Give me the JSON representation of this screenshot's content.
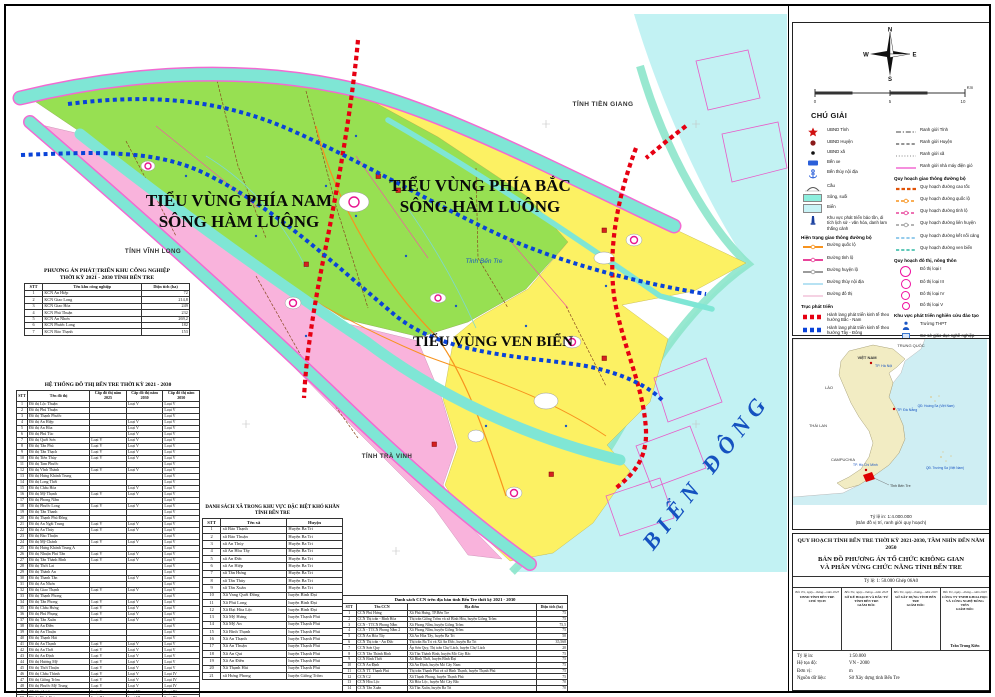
{
  "colors": {
    "region_north": "#97e052",
    "region_south": "#f9b3dc",
    "region_coast": "#fcf163",
    "sea": "#c2f2f3",
    "river": "#7fe6d5",
    "corridor_ns": "#e60012",
    "corridor_we": "#0a43d8",
    "province_boundary": "#f26ad2"
  },
  "map": {
    "labels": {
      "region_south_1": "TIỂU VÙNG PHÍA NAM",
      "region_south_2": "SÔNG HÀM LUÔNG",
      "region_north_1": "TIỂU VÙNG PHÍA BẮC",
      "region_north_2": "SÔNG HÀM LUÔNG",
      "region_coast": "TIỂU VÙNG VEN BIỂN",
      "tien_giang": "TỈNH TIỀN GIANG",
      "vinh_long": "TỈNH VĨNH LONG",
      "tra_vinh": "TỈNH TRÀ VINH",
      "ben_tre": "Tỉnh Bến Tre",
      "sea": "BIỂN ĐÔNG",
      "scale": "TỶ LỆ 1: 50 000"
    }
  },
  "tables": {
    "industrial": {
      "title1": "PHƯƠNG ÁN PHÁT TRIỂN KHU CÔNG NGHIỆP",
      "title2": "THỜI KỲ 2021 - 2030 TỈNH BẾN TRE",
      "headers": [
        "STT",
        "Tên khu công nghiệp",
        "Diện tích (ha)"
      ],
      "rows": [
        [
          "1",
          "KCN An Hiệp",
          "72"
        ],
        [
          "2",
          "KCN Giao Long",
          "214,8"
        ],
        [
          "3",
          "KCN Giao Hòa",
          "249"
        ],
        [
          "4",
          "KCN Phú Thuận",
          "232"
        ],
        [
          "5",
          "KCN An Nhơn",
          "269,2"
        ],
        [
          "6",
          "KCN Phước Long",
          "182"
        ],
        [
          "7",
          "KCN Bảo Thạnh",
          "153"
        ]
      ]
    },
    "urban": {
      "title1": "HỆ THỐNG ĐÔ THỊ BẾN TRE THỜI KỲ 2021 - 2030",
      "headers": [
        "STT",
        "Tên đô thị",
        "Cấp đô thị năm 2025",
        "Cấp đô thị năm 2030",
        "Cấp đô thị năm 2050"
      ],
      "rows": [
        [
          "1",
          "Đô thị Lộc Thuận",
          "",
          "Loại V",
          "Loại V"
        ],
        [
          "2",
          "Đô thị Phú Thuận",
          "",
          "",
          "Loại V"
        ],
        [
          "3",
          "Đô thị Thạnh Phước",
          "",
          "",
          "Loại V"
        ],
        [
          "4",
          "Đô thị An Hiệp",
          "",
          "Loại V",
          "Loại V"
        ],
        [
          "5",
          "Đô thị An Hòa",
          "",
          "Loại V",
          "Loại V"
        ],
        [
          "6",
          "Đô thị Phú Túc",
          "",
          "Loại V",
          "Loại V"
        ],
        [
          "7",
          "Đô thị Quới Sơn",
          "Loại V",
          "Loại V",
          "Loại V"
        ],
        [
          "8",
          "Đô thị Tân Phú",
          "Loại V",
          "Loại V",
          "Loại V"
        ],
        [
          "9",
          "Đô thị Tân Thạch",
          "Loại V",
          "Loại V",
          "Loại V"
        ],
        [
          "10",
          "Đô thị Tiên Thủy",
          "Loại V",
          "Loại V",
          "Loại V"
        ],
        [
          "11",
          "Đô thị Tam Phước",
          "",
          "",
          "Loại V"
        ],
        [
          "12",
          "Đô thị Vĩnh Thành",
          "Loại V",
          "Loại V",
          "Loại V"
        ],
        [
          "13",
          "Đô thị Hưng Khánh Trung",
          "",
          "",
          "Loại V"
        ],
        [
          "14",
          "Đô thị Long Thới",
          "",
          "",
          "Loại V"
        ],
        [
          "15",
          "Đô thị Châu Hòa",
          "",
          "Loại V",
          "Loại V"
        ],
        [
          "16",
          "Đô thị Mỹ Thạnh",
          "Loại V",
          "Loại V",
          "Loại V"
        ],
        [
          "17",
          "Đô thị Phong Nẫm",
          "",
          "",
          "Loại V"
        ],
        [
          "18",
          "Đô thị Phước Long",
          "Loại V",
          "Loại V",
          "Loại V"
        ],
        [
          "19",
          "Đô thị Tân Thanh",
          "",
          "",
          "Loại V"
        ],
        [
          "20",
          "Đô thị Thạnh Phú Đông",
          "",
          "",
          "Loại V"
        ],
        [
          "21",
          "Đô thị An Ngãi Trung",
          "Loại V",
          "Loại V",
          "Loại V"
        ],
        [
          "22",
          "Đô thị An Thủy",
          "Loại V",
          "Loại V",
          "Loại V"
        ],
        [
          "23",
          "Đô thị Bảo Thuận",
          "",
          "",
          "Loại V"
        ],
        [
          "24",
          "Đô thị Mỹ Chánh",
          "Loại V",
          "Loại V",
          "Loại V"
        ],
        [
          "25",
          "Đô thị Hưng Khánh Trung A",
          "",
          "",
          "Loại V"
        ],
        [
          "26",
          "Đô thị Nhuận Phú Tân",
          "Loại V",
          "Loại V",
          "Loại V"
        ],
        [
          "27",
          "Đô thị Tân Thành Bình",
          "Loại V",
          "Loại V",
          "Loại V"
        ],
        [
          "28",
          "Đô thị Thới Lai",
          "",
          "",
          "Loại V"
        ],
        [
          "29",
          "Đô thị Thành An",
          "",
          "",
          "Loại V"
        ],
        [
          "30",
          "Đô thị Thanh Tân",
          "",
          "Loại V",
          "Loại V"
        ],
        [
          "31",
          "Đô thị An Nhơn",
          "",
          "",
          "Loại V"
        ],
        [
          "32",
          "Đô thị Giao Thạnh",
          "Loại V",
          "Loại V",
          "Loại V"
        ],
        [
          "33",
          "Đô thị Thạnh Phong",
          "",
          "",
          "Loại V"
        ],
        [
          "34",
          "Đô thị Tân Phong",
          "Loại V",
          "Loại V",
          "Loại V"
        ],
        [
          "35",
          "Đô thị Châu Hưng",
          "Loại V",
          "Loại V",
          "Loại V"
        ],
        [
          "36",
          "Đô thị Phú Phụng",
          "Loại V",
          "Loại V",
          "Loại V"
        ],
        [
          "37",
          "Đô thị Tân Xuân",
          "Loại V",
          "Loại V",
          "Loại V"
        ],
        [
          "38",
          "Đô thị An Điền",
          "",
          "",
          "Loại V"
        ],
        [
          "39",
          "Đô thị An Thuận",
          "",
          "",
          "Loại V"
        ],
        [
          "40",
          "Đô thị Thạnh Hải",
          "",
          "",
          "Loại V"
        ],
        [
          "41",
          "Đô thị An Thạnh",
          "Loại V",
          "Loại V",
          "Loại V"
        ],
        [
          "42",
          "Đô thị An Thới",
          "Loại V",
          "Loại V",
          "Loại V"
        ],
        [
          "43",
          "Đô thị An Định",
          "Loại V",
          "Loại V",
          "Loại V"
        ],
        [
          "44",
          "Đô thị Hương Mỹ",
          "Loại V",
          "Loại V",
          "Loại V"
        ],
        [
          "45",
          "Đô thị Thới Thuận",
          "Loại V",
          "Loại V",
          "Loại V"
        ],
        [
          "46",
          "Đô thị Châu Thành",
          "Loại V",
          "Loại V",
          "Loại IV"
        ],
        [
          "47",
          "Đô thị Giồng Trôm",
          "Loại V",
          "Loại V",
          "Loại IV"
        ],
        [
          "48",
          "Đô thị Phước Mỹ Trung",
          "Loại V",
          "Loại V",
          "Loại IV"
        ],
        [
          "49",
          "TT Chợ Lách",
          "Loại V",
          "Loại IV",
          "Loại III"
        ],
        [
          "50",
          "Đô thị Bình Đại",
          "Loại IV",
          "Loại III",
          "Loại III"
        ],
        [
          "51",
          "Đô thị Ba Tri",
          "Loại IV",
          "Loại III",
          "Loại III"
        ],
        [
          "52",
          "Đô thị Thạnh Phú",
          "Loại V",
          "Loại III",
          "Loại III"
        ],
        [
          "53",
          "Thị trấn Mỏ Cày",
          "Loại IV",
          "Loại III",
          "Loại II"
        ],
        [
          "54",
          "Đô thị Bến Tre",
          "",
          "Loại I",
          "Loại I"
        ]
      ]
    },
    "communes": {
      "title1": "DANH SÁCH XÃ TRONG KHU VỰC ĐẶC BIỆT KHÓ KHĂN",
      "title2": "TỈNH BẾN TRE",
      "headers": [
        "STT",
        "Tên xã",
        "Huyện"
      ],
      "rows": [
        [
          "1",
          "xã Bảo Thạnh",
          "Huyện Ba Tri"
        ],
        [
          "2",
          "xã Bảo Thuận",
          "Huyện Ba Tri"
        ],
        [
          "3",
          "xã An Thủy",
          "Huyện Ba Tri"
        ],
        [
          "4",
          "xã An Hòa Tây",
          "Huyện Ba Tri"
        ],
        [
          "5",
          "xã An Đức",
          "Huyện Ba Tri"
        ],
        [
          "6",
          "xã An Hiệp",
          "Huyện Ba Tri"
        ],
        [
          "7",
          "xã Tân Hưng",
          "Huyện Ba Tri"
        ],
        [
          "8",
          "xã Tân Thủy",
          "Huyện Ba Tri"
        ],
        [
          "9",
          "xã Tân Xuân",
          "Huyện Ba Tri"
        ],
        [
          "10",
          "Xã Vang Quới Đông",
          "huyện Bình Đại"
        ],
        [
          "11",
          "Xã Phú Long",
          "huyện Bình Đại"
        ],
        [
          "12",
          "Xã Đại Hòa Lộc",
          "huyện Bình Đại"
        ],
        [
          "13",
          "Xã Mỹ Hưng",
          "huyện Thạnh Phú"
        ],
        [
          "14",
          "Xã Mỹ An",
          "huyện Thạnh Phú"
        ],
        [
          "15",
          "Xã Bình Thạnh",
          "huyện Thạnh Phú"
        ],
        [
          "16",
          "Xã An Thạnh",
          "huyện Thạnh Phú"
        ],
        [
          "17",
          "Xã An Thuận",
          "huyện Thạnh Phú"
        ],
        [
          "18",
          "Xã An Qui",
          "huyện Thạnh Phú"
        ],
        [
          "19",
          "Xã An Điền",
          "huyện Thạnh Phú"
        ],
        [
          "20",
          "Xã Thạnh Hải",
          "huyện Thạnh Phú"
        ],
        [
          "21",
          "xã Hưng Phong",
          "huyện Giồng Trôm"
        ]
      ]
    },
    "ccn": {
      "title1": "Danh sách CCN trên địa bàn tỉnh Bến Tre thời kỳ 2021 - 2030",
      "headers": [
        "STT",
        "Tên CCN",
        "Địa điểm",
        "Diện tích (ha)"
      ],
      "rows": [
        [
          "1",
          "CCN Phú Hưng",
          "Xã Phú Hưng, TP.Bến Tre",
          "75"
        ],
        [
          "2",
          "CCN Thị trấn - Bình Hòa",
          "Thị trấn Giồng Trôm và xã Bình Hòa, huyện Giồng Trôm",
          "75"
        ],
        [
          "3",
          "CCN - TTCN Phong Nẫm",
          "Xã Phong Nẫm, huyện Giồng Trôm",
          "75,5"
        ],
        [
          "4",
          "CCN - TTCN Phong Nẫm 2",
          "Xã Phong Nẫm, huyện Giồng Trôm",
          "75"
        ],
        [
          "5",
          "CCN An Hòa Tây",
          "Xã An Hòa Tây, huyện Ba Tri",
          "50"
        ],
        [
          "6",
          "CCN Thị trấn - An Đức",
          "Thị trấn Ba Tri và Xã An Đức, huyện Ba Tri",
          "35,568"
        ],
        [
          "7",
          "CCN Sơn Quy",
          "Ấp Sơn Quy, Thị trấn Chợ Lách, huyện Chợ Lách",
          "20"
        ],
        [
          "8",
          "CCN Tân Thành Bình",
          "Xã Tân Thành Bình, huyện Mỏ Cày Bắc",
          "75"
        ],
        [
          "9",
          "CCN Bình Thới",
          "Xã Bình Thới, huyện Bình Đại",
          "75"
        ],
        [
          "10",
          "CCN An Định",
          "Xã An Định, huyện Mỏ Cày Nam",
          "75"
        ],
        [
          "11",
          "CCN TT. Thạnh Phú",
          "Thị trấn Thạnh Phú và xã Bình Thạnh, huyện Thạnh Phú",
          "75"
        ],
        [
          "12",
          "CCN C2",
          "Xã Thạnh Phong, huyện Thạnh Phú",
          "75"
        ],
        [
          "13",
          "CCN Hòa Lộc",
          "Xã Hòa Lộc, huyện Mỏ Cày Bắc",
          "70"
        ],
        [
          "14",
          "CCN Tân Xuân",
          "Xã Tân Xuân, huyện Ba Tri",
          "70"
        ]
      ]
    }
  },
  "legend": {
    "title": "CHÚ GIẢI",
    "compass": {
      "n": "N",
      "e": "E",
      "s": "S",
      "w": "W"
    },
    "scalebar": {
      "t0": "0",
      "t1": "5",
      "t2": "10",
      "unit": "Km"
    },
    "left": [
      {
        "l": "UBND Tỉnh",
        "s": "star",
        "c": "#d01010"
      },
      {
        "l": "UBND Huyện",
        "s": "circ",
        "c": "#8b1a1a"
      },
      {
        "l": "UBND xã",
        "s": "dot",
        "c": "#111111"
      },
      {
        "l": "Bến xe",
        "s": "rect",
        "c": "#2b5fd9"
      },
      {
        "l": "Bến thủy nội địa",
        "s": "anchor",
        "c": "#2b5fd9"
      },
      {
        "l": "Cầu",
        "s": "bridge",
        "c": "#555555"
      },
      {
        "l": "Sông, suối",
        "s": "fill",
        "c": "#8ceedd"
      },
      {
        "l": "Biển",
        "s": "fill",
        "c": "#c9f3f6"
      },
      {
        "l": "Khu vực phát triển bảo tồn, di tích lịch sử - văn hóa, danh lam thắng cảnh",
        "s": "mon",
        "c": "#1a3f9e"
      },
      {
        "h": "Hiện trạng giao thông đường bộ"
      },
      {
        "l": "Đường quốc lộ",
        "s": "road",
        "c": "#f7931e"
      },
      {
        "l": "Đường tỉnh lộ",
        "s": "road",
        "c": "#e8439a"
      },
      {
        "l": "Đường huyện lộ",
        "s": "road",
        "c": "#9b9b9b"
      },
      {
        "l": "Đường thủy nội địa",
        "s": "line",
        "c": "#9fd8ef"
      },
      {
        "l": "Đường đô thị",
        "s": "line",
        "c": "#f2c4da"
      },
      {
        "h": "Trục phát triển"
      },
      {
        "l": "Hành lang phát triển kinh tế theo hướng Bắc - Nam",
        "s": "sq",
        "c": "#e60012"
      },
      {
        "l": "Hành lang phát triển kinh tế theo hướng Tây - Đông",
        "s": "sq",
        "c": "#0a43d8"
      },
      {
        "l": "Tiểu vùng phía Bắc sông Hàm Luông",
        "s": "fill",
        "c": "#97e052"
      },
      {
        "l": "Tiểu vùng phía Nam sông Hàm Luông",
        "s": "fill",
        "c": "#f9b3dc"
      },
      {
        "l": "Tiểu vùng ven biển",
        "s": "fill",
        "c": "#fcf163"
      },
      {
        "h": "Khu kinh tế, KCN, CCN"
      },
      {
        "l": "Vị trí KCN, CCN",
        "s": "fact",
        "c": "#cc2020"
      },
      {
        "l": "Khoanh vi KCN, CCN",
        "s": "hatch",
        "c": "#7799cc"
      }
    ],
    "right": [
      {
        "l": "Ranh giới Tỉnh",
        "s": "dashdot",
        "c": "#444444"
      },
      {
        "l": "Ranh giới Huyện",
        "s": "dash",
        "c": "#555555"
      },
      {
        "l": "Ranh giới xã",
        "s": "dots",
        "c": "#888888"
      },
      {
        "l": "Ranh giới nhà máy điện gió",
        "s": "line",
        "c": "#f26ad2"
      },
      {
        "h": "Quy hoạch giao thông đường bộ"
      },
      {
        "l": "Quy hoạch đường cao tốc",
        "s": "dash2",
        "c": "#e05206"
      },
      {
        "l": "Quy hoạch đường quốc lộ",
        "s": "roaddash",
        "c": "#f7931e"
      },
      {
        "l": "Quy hoạch đường tỉnh lộ",
        "s": "roaddash",
        "c": "#e8439a"
      },
      {
        "l": "Quy hoạch đường liên huyện",
        "s": "roaddash",
        "c": "#9b9b9b"
      },
      {
        "l": "Quy hoạch đường kết nối cảng",
        "s": "dash",
        "c": "#58aee0"
      },
      {
        "l": "Quy hoạch đường ven biển",
        "s": "dash",
        "c": "#00a98f"
      },
      {
        "h": "Quy hoạch đô thị, nông thôn"
      },
      {
        "l": "Đô thị loại I",
        "s": "ring",
        "c": "#ef11a0",
        "z": 9
      },
      {
        "l": "Đô thị loại III",
        "s": "ring",
        "c": "#ef11a0",
        "z": 8
      },
      {
        "l": "Đô thị loại IV",
        "s": "ring",
        "c": "#ef11a0",
        "z": 7
      },
      {
        "l": "Đô thị loại V",
        "s": "ring",
        "c": "#ef11a0",
        "z": 6
      },
      {
        "h": "Khu vực phát triển nghiên cứu đào tạo"
      },
      {
        "l": "Trường THPT",
        "s": "pers",
        "c": "#1a56c4"
      },
      {
        "l": "Cơ sở giáo dục nghề nghiệp",
        "s": "sch",
        "c": "#3a77d0"
      },
      {
        "h": "Khu vực đặc biệt khó khăn"
      },
      {
        "l": "Khu vực đặc biệt khó khăn",
        "s": "white",
        "c": "#999999"
      }
    ]
  },
  "inset": {
    "labels": {
      "trung_quoc": "TRUNG QUỐC",
      "viet_nam": "VIỆT NAM",
      "ha_noi": "TP. Hà Nội",
      "lao": "LÀO",
      "thai_lan": "THÁI LAN",
      "campuchia": "CAMPUCHIA",
      "da_nang": "TP. Đà Nẵng",
      "hoang_sa": "QĐ. Hoàng Sa (Việt Nam)",
      "ho_chi_minh": "TP. Hồ Chí Minh",
      "ben_tre": "Tỉnh Bến Tre",
      "truong_sa": "QĐ. Trường Sa (Việt Nam)"
    },
    "caption1": "Tỷ lệ in: 1:4.000.000",
    "caption2": "(Bản đồ vị trí, ranh giới quy hoạch)"
  },
  "titleblock": {
    "line1": "QUY HOẠCH TỈNH BẾN TRE THỜI KỲ 2021-2030, TẦM NHÌN ĐẾN NĂM 2050",
    "line2a": "BẢN ĐỒ PHƯƠNG ÁN TỔ CHỨC KHÔNG GIAN",
    "line2b": "VÀ PHÂN VÙNG CHỨC NĂNG TỈNH BẾN TRE",
    "scale_line": "Tỷ lệ: 1: 50.000 Ghép 06A0",
    "signatures": [
      {
        "date": "Bến Tre, ngày....tháng....năm 2023",
        "org": "UBND TỈNH BẾN TRE",
        "role": "CHỦ TỊCH",
        "signer": ""
      },
      {
        "date": "Bến Tre, ngày....tháng....năm 2023",
        "org": "SỞ KẾ HOẠCH VÀ ĐẦU TƯ TỈNH BẾN TRE",
        "role": "GIÁM ĐỐC",
        "signer": ""
      },
      {
        "date": "Bến Tre, ngày....tháng....năm 2023",
        "org": "SỞ XÂY DỰNG TỈNH BẾN TRE",
        "role": "GIÁM ĐỐC",
        "signer": ""
      },
      {
        "date": "Bến Tre, ngày....tháng....năm 2023",
        "org": "CÔNG TY TNHH KHOA HỌC VÀ CÔNG NGHỆ ĐÔNG TIẾN",
        "role": "GIÁM ĐỐC",
        "signer": "Trần Trung Kiên"
      }
    ],
    "meta": [
      [
        "Tỷ lệ in:",
        "1:50.000"
      ],
      [
        "Hệ tọa độ:",
        "VN - 2000"
      ],
      [
        "Đơn vị:",
        "m"
      ],
      [
        "Nguồn dữ liệu:",
        "Sở Xây dựng tỉnh Bến Tre"
      ]
    ]
  }
}
